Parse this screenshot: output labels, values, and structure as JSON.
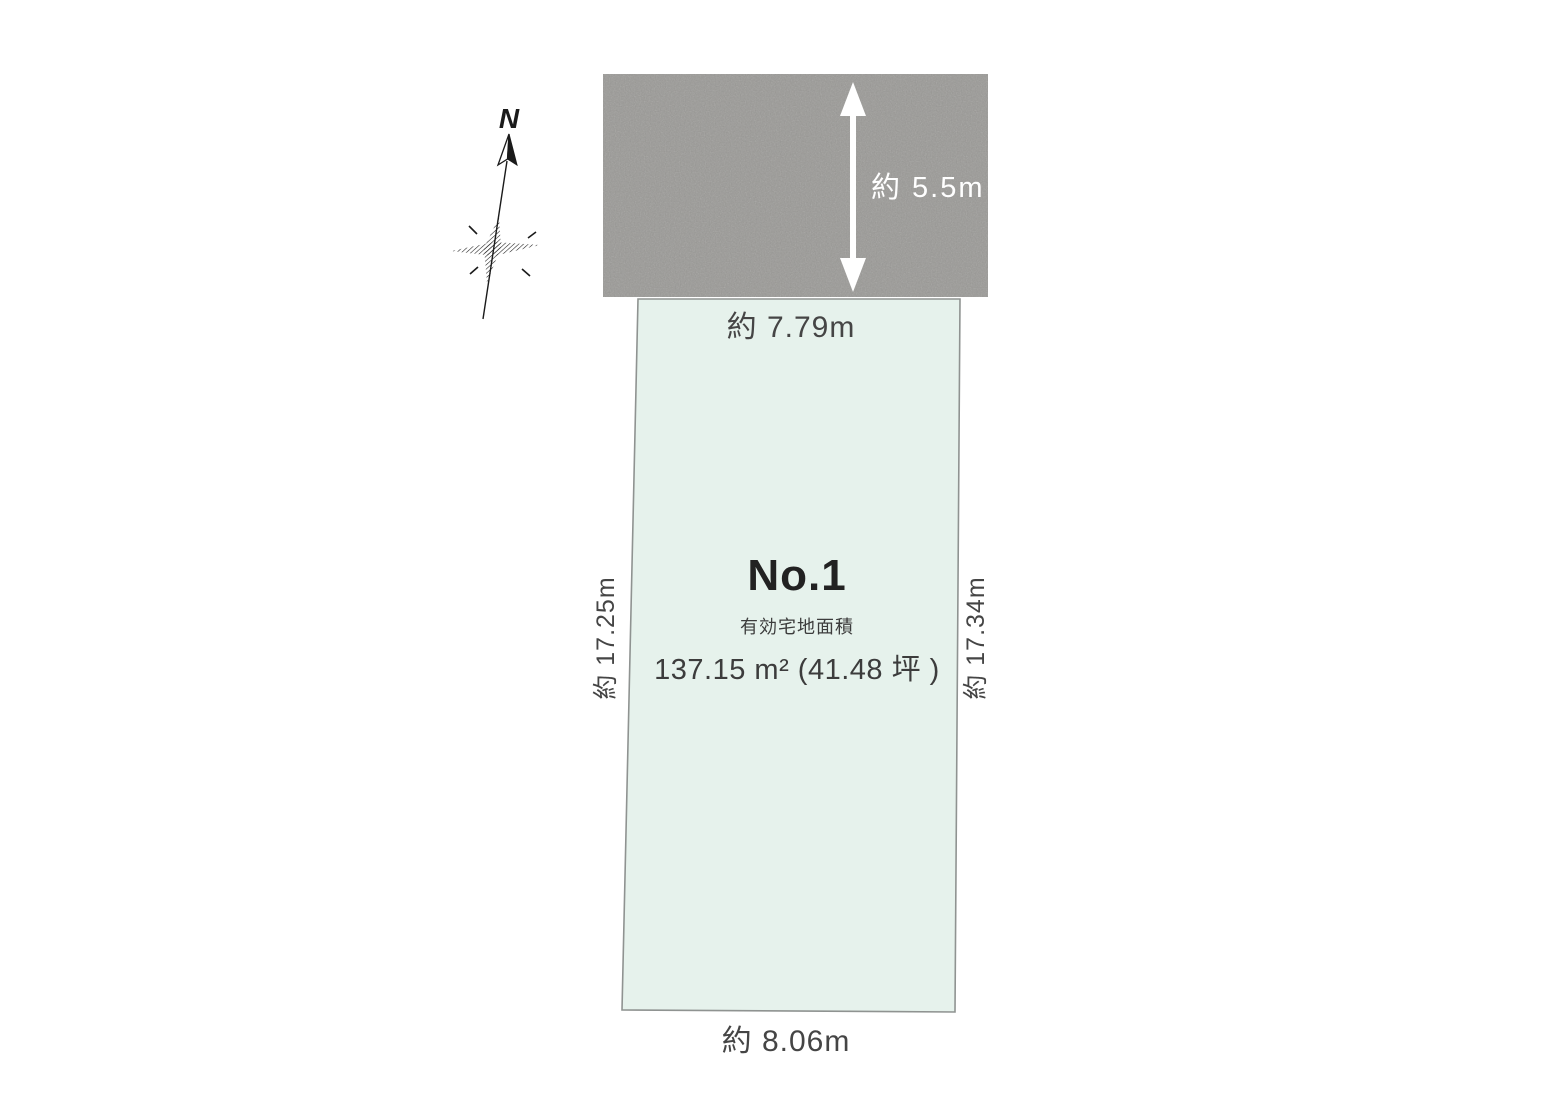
{
  "diagram": {
    "colors": {
      "background": "#ffffff",
      "road_fill": "#9a9996",
      "road_label": "#ffffff",
      "lot_fill": "#e6f2ec",
      "lot_border": "#8f9391",
      "label_ink": "#454545",
      "title_ink": "#222222",
      "caption_ink": "#3c3c3c",
      "compass_ink": "#1a1a1a",
      "arrow": "#ffffff"
    },
    "compass": {
      "north_label": "N",
      "icon": "north-compass-icon"
    },
    "road": {
      "depth_label": "約 5.5m",
      "icon": "double-headed-vertical-arrow-icon"
    },
    "lot": {
      "name": "No.1",
      "area_caption": "有効宅地面積",
      "area_value": "137.15 m² (41.48 坪 )",
      "north_edge_label": "約 7.79m",
      "west_edge_label": "約 17.25m",
      "east_edge_label": "約 17.34m",
      "south_edge_label": "約 8.06m"
    }
  }
}
